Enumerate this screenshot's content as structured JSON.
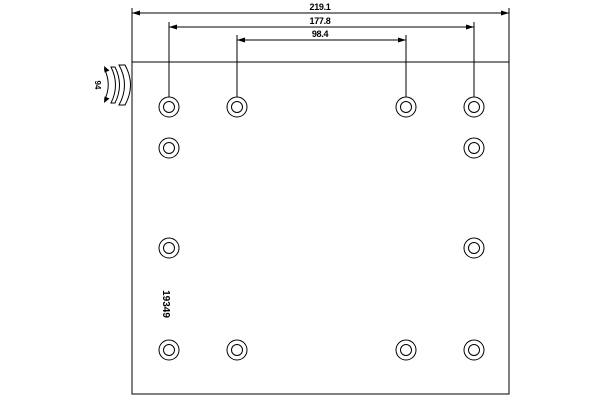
{
  "drawing": {
    "part_number": "19349",
    "dimensions": {
      "overall_width": "219.1",
      "outer_hole_spacing": "177.8",
      "inner_hole_spacing": "98.4"
    },
    "curvature_label": "94",
    "hole_pattern": {
      "total_holes": 12,
      "outer_radius": 10,
      "inner_radius": 5.5,
      "rows": [
        {
          "y": 107,
          "x": [
            169,
            237,
            406,
            474
          ]
        },
        {
          "y": 148,
          "x": [
            169,
            474
          ]
        },
        {
          "y": 248,
          "x": [
            169,
            474
          ]
        },
        {
          "y": 350,
          "x": [
            169,
            237,
            406,
            474
          ]
        }
      ]
    },
    "colors": {
      "line": "#000000",
      "background": "#ffffff"
    }
  }
}
